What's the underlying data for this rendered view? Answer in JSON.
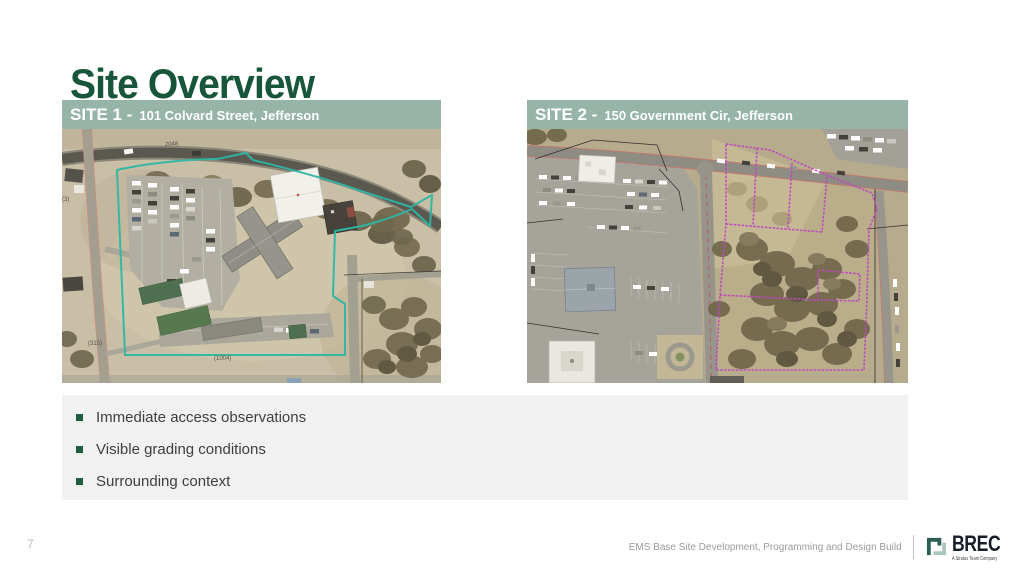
{
  "slide": {
    "title": "Site Overview",
    "page_number": "7",
    "footer": "EMS Base Site Development, Programming and Design Build"
  },
  "logo": {
    "name": "BREC",
    "tagline": "A Stratus Team Company"
  },
  "sites": {
    "site1": {
      "label": "SITE 1 -",
      "address": "101 Colvard Street, Jefferson",
      "boundary_color": "#2db6a3",
      "map_labels": {
        "road_top": "2048",
        "route65": "(65)",
        "route3": "(3)",
        "parcel315": "(315)",
        "parcel1004": "(1004)"
      }
    },
    "site2": {
      "label": "SITE 2 -",
      "address": "150 Government Cir, Jefferson",
      "boundary_color": "#c046c0"
    }
  },
  "bullets": {
    "items": [
      "Immediate access observations",
      "Visible grading conditions",
      "Surrounding context"
    ]
  },
  "colors": {
    "title_green": "#17563a",
    "header_sage": "#96b4a7",
    "panel_gray": "#f1f1f1",
    "bullet_green": "#1c5e40"
  }
}
